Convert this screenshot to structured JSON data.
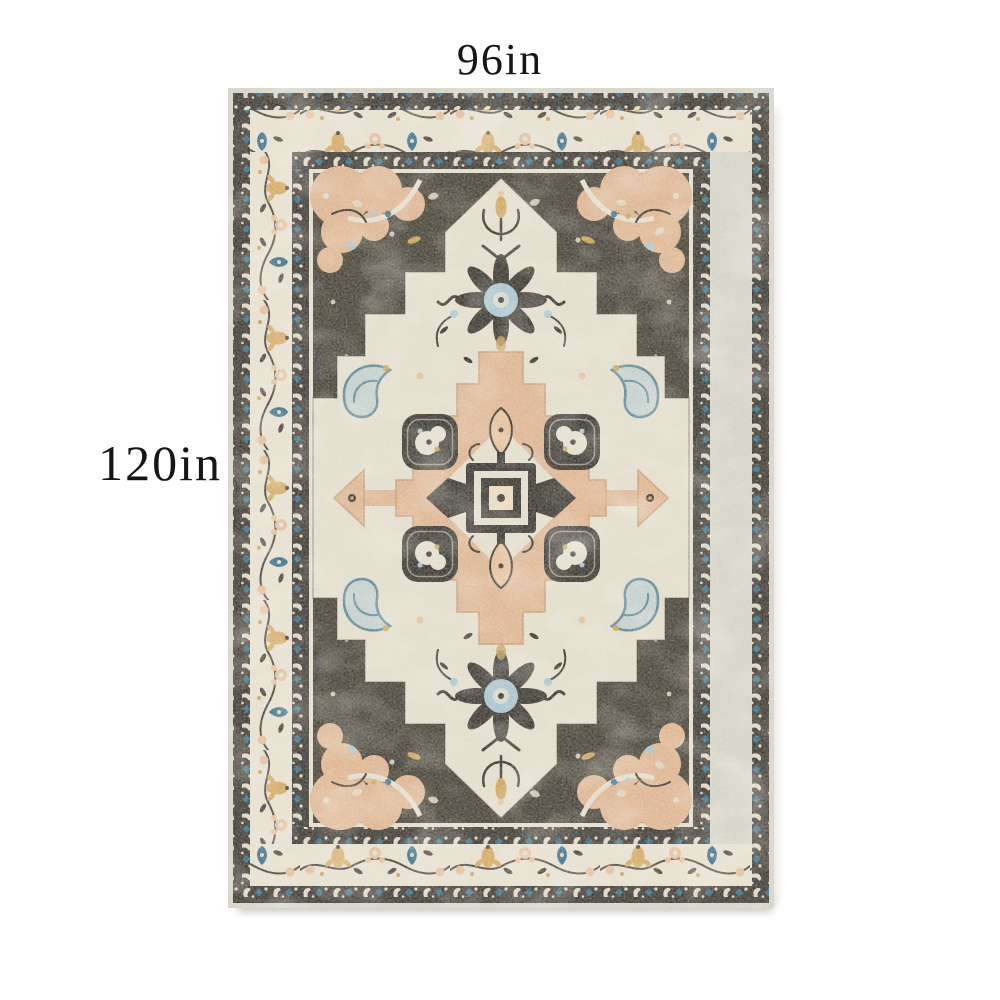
{
  "page": {
    "background_color": "#ffffff"
  },
  "annotations": {
    "width_label": "96in",
    "height_label": "120in",
    "label_color": "#161616"
  },
  "rug": {
    "alt": "Distressed vintage-style medallion area rug with cream, charcoal, peach, gold and blue pattern",
    "palette": {
      "edge": "#d5d3c8",
      "band_dark": "#3f3b35",
      "band_motif_cream": "#ddd6c4",
      "band_motif_blue": "#3a7089",
      "border_cream": "#e6e0d0",
      "border_gold": "#d4aa66",
      "border_peach": "#e4bf9b",
      "border_blue": "#3e718d",
      "border_leaf": "#4e483f",
      "field": "#474338",
      "field_motif": "#ded8c6",
      "medallion_cream": "#e2ddcc",
      "medallion_peach": "#ddb491",
      "ornament_charcoal": "#3a3731",
      "accent_blue": "#a7c3cf",
      "accent_teal": "#5d8794",
      "accent_gold": "#c9a155",
      "center_cream": "#e9d9bd",
      "shadow": "#b7b5ab"
    }
  }
}
